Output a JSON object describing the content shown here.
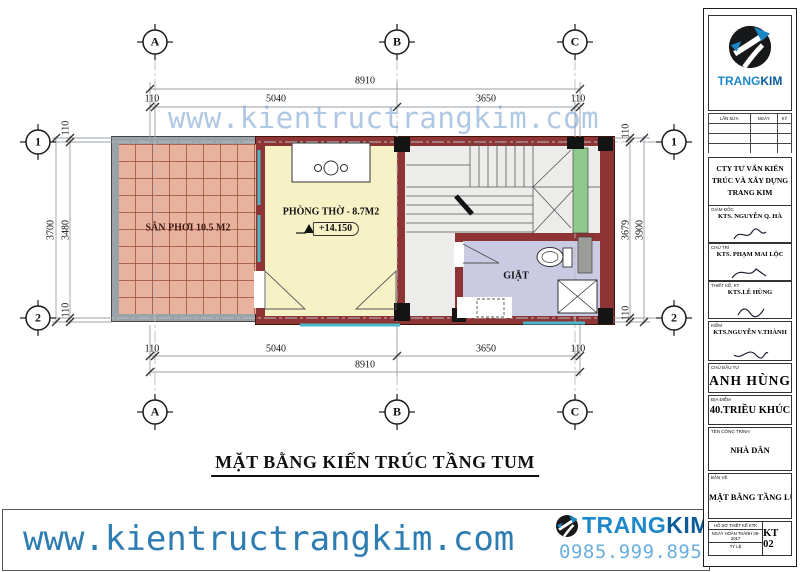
{
  "plan": {
    "watermark": "www.kientructrangkim.com",
    "title": "MẶT BẰNG KIẾN TRÚC TẦNG TUM",
    "rooms": {
      "san_phoi": "SÂN PHƠI 10.5 M2",
      "phong_tho": "PHÒNG THỜ - 8.7M2",
      "phong_tho_level": "+14.150",
      "giat": "GIẶT"
    },
    "grid_cols": [
      "A",
      "B",
      "C"
    ],
    "grid_rows": [
      "1",
      "2"
    ],
    "dims": {
      "top_overall": "8910",
      "top_segs": [
        "110",
        "5040",
        "3650",
        "110"
      ],
      "bottom_overall": "8910",
      "bottom_segs": [
        "110",
        "5040",
        "3650",
        "110"
      ],
      "left_overall": "3700",
      "left_segs": [
        "110",
        "3480",
        "110"
      ],
      "right_overall": "3900",
      "right_segs": [
        "110",
        "3679",
        "110"
      ]
    }
  },
  "footer": {
    "website": "www.kientructrangkim.com",
    "phone": "0985.999.895",
    "brand": {
      "part1": "TRANG",
      "part2": "KIM"
    }
  },
  "titleblock": {
    "brand": {
      "part1": "TRANG",
      "part2": "KIM"
    },
    "revision_headers": [
      "LẦN SỬA",
      "NGÀY",
      "KÝ"
    ],
    "company": "CTY TƯ VẤN KIẾN TRÚC VÀ XÂY DỰNG TRANG KIM",
    "signers": [
      {
        "role": "GIÁM ĐỐC",
        "name": "KTS. NGUYỄN Q. HÀ"
      },
      {
        "role": "CHỦ TRÌ",
        "name": "KTS. PHẠM MAI LỘC"
      },
      {
        "role": "THIẾT KẾ, KT",
        "name": "KTS.LÊ HÙNG"
      },
      {
        "role": "KIỂM",
        "name": "KTS.NGUYỄN V.THÀNH"
      }
    ],
    "client_label": "CHỦ ĐẦU TƯ",
    "client": "ANH HÙNG",
    "address_label": "ĐỊA ĐIỂM",
    "address": "40.TRIỀU KHÚC",
    "project_label": "TÊN CÔNG TRÌNH",
    "project": "NHÀ DÂN",
    "drawing_label": "BẢN VẼ",
    "drawing": "MẶT BẰNG TẦNG LỬNG",
    "meta": {
      "design_doc": "HỒ SƠ THIẾT KẾ KTK",
      "completed": "NGÀY HOÀN THÀNH 09-2017",
      "scale_label": "TỶ LỆ",
      "sheet_no": "KT 02"
    }
  },
  "colors": {
    "brand_blue": "#1e88c8",
    "brand_dark_blue": "#0c5c9c",
    "wall_maroon": "#8e3434",
    "balcony_fill": "#e9b29f",
    "worship_fill": "#f6f2c6",
    "laundry_fill": "#cacae3",
    "planter_green": "#8fc98b",
    "glass_cyan": "#49b8c8",
    "watermark_blue": "#6e9bcd"
  }
}
